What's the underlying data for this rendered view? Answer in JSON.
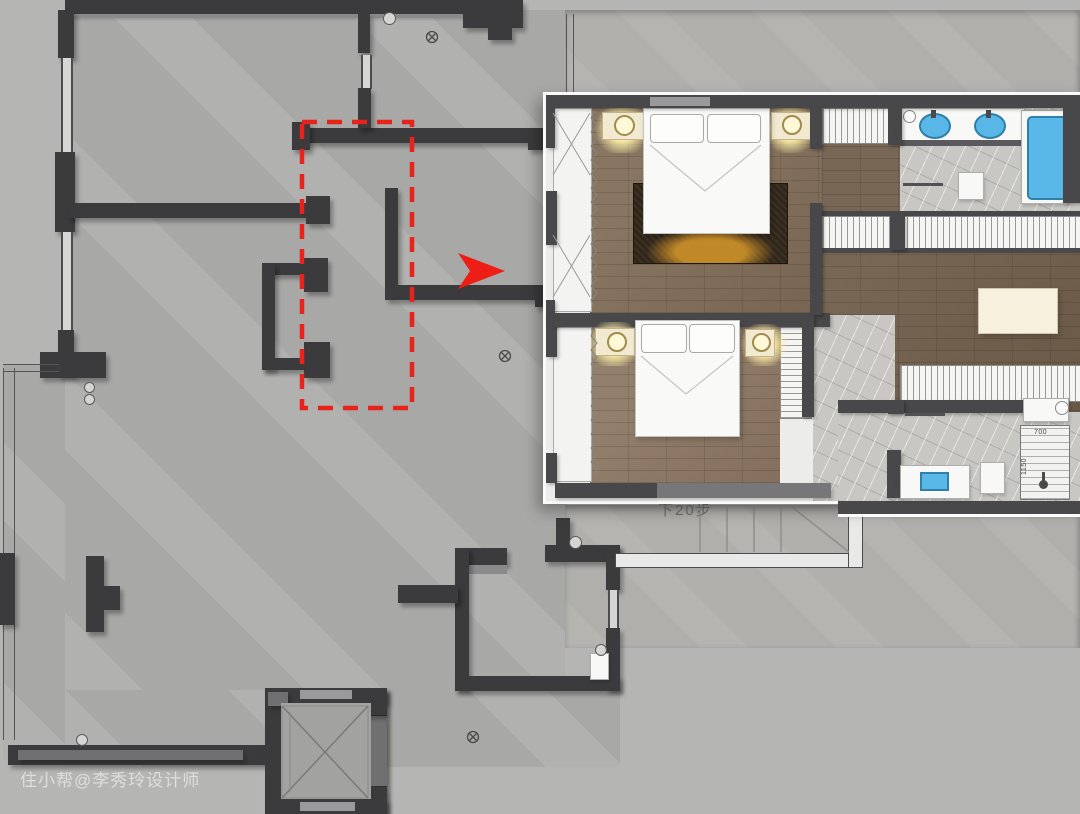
{
  "watermark": {
    "text": "住小帮@李秀玲设计师"
  },
  "base_plan": {
    "type": "original-structure-floor-plan",
    "stairs_label": "下20步",
    "highlight_box": {
      "shape": "dashed-rectangle",
      "color": "#e8231c"
    },
    "arrow": {
      "shape": "right-pointer",
      "color": "#ee1d16"
    }
  },
  "overlay_plan": {
    "type": "furnished-renovation-plan",
    "dimensions": {
      "d440": "440",
      "d550": "550",
      "d700": "700",
      "d1150": "1150"
    },
    "fixtures": [
      "double-bed",
      "nightstand-lamp",
      "area-rug",
      "wardrobe",
      "vanity-double-sink",
      "bathtub",
      "shower",
      "toilet",
      "ottoman",
      "curtain"
    ]
  },
  "colors": {
    "background": "#b5b5b3",
    "floor_concrete": "#a8a8a6",
    "wall_dark": "#3b3b3d",
    "wall_mid": "#707073",
    "highlight_red": "#e8231c",
    "wood_floor": "#7e6a55",
    "marble_floor": "#c9c7c3",
    "fixture_blue": "#58b7e7",
    "lamp_glow": "#fcee a5",
    "lamp_glow_hex": "#fceea5"
  }
}
